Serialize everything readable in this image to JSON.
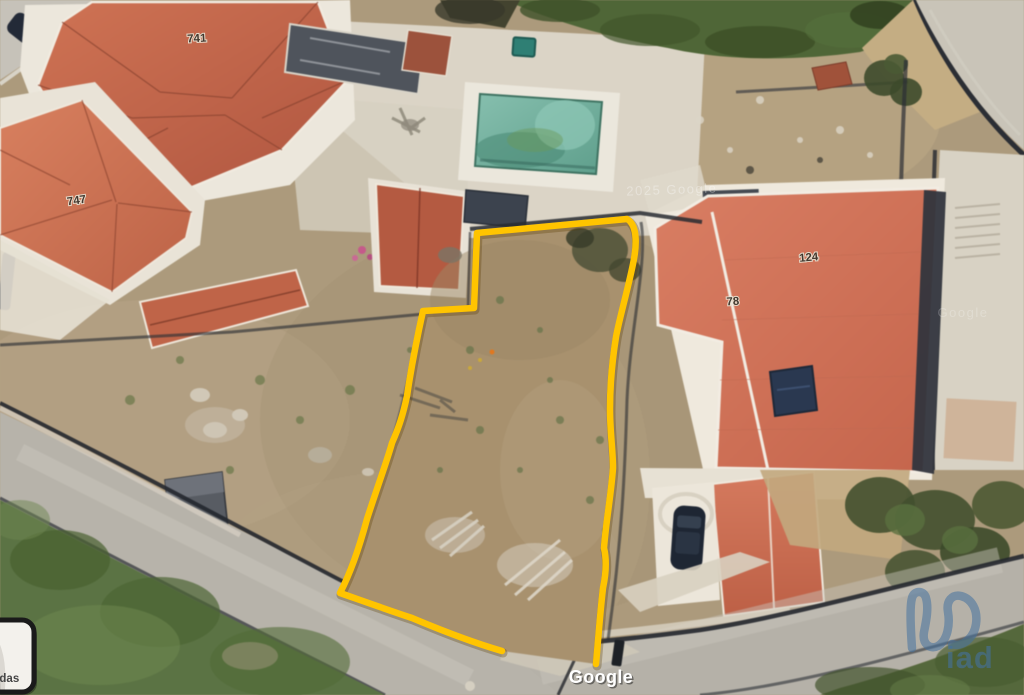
{
  "map": {
    "house_numbers": [
      "741",
      "747",
      "124",
      "78"
    ],
    "attribution": "Google",
    "imagery_watermarks": [
      "2025 Google",
      "Google"
    ]
  },
  "overlay": {
    "plot_outline_color": "#ffc400"
  },
  "brand": {
    "name": "iad",
    "color": "#44719f"
  },
  "inset": {
    "label": "madas"
  }
}
